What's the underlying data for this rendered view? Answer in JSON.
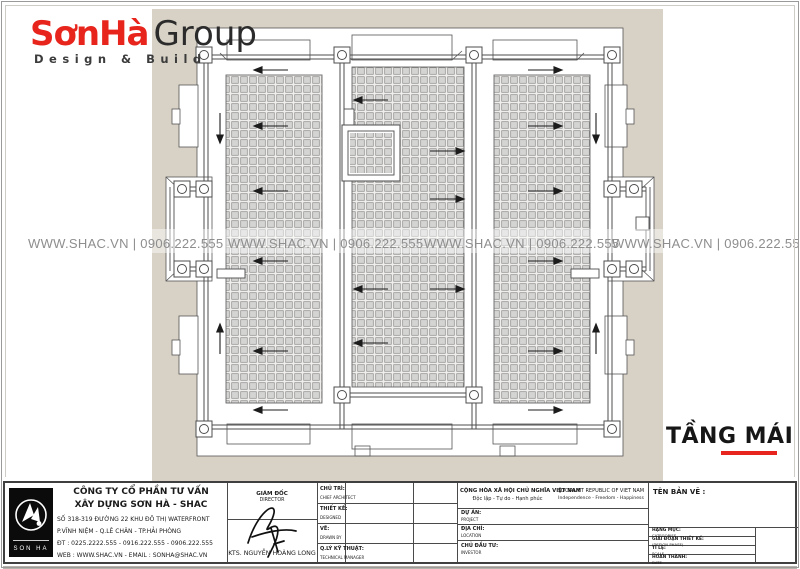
{
  "brand": {
    "name_red": "SơnHà",
    "name_dark": "Group",
    "tagline": "Design & Build"
  },
  "watermark": {
    "text": "WWW.SHAC.VN  |  0906.222.555"
  },
  "drawing": {
    "title": "TẦNG MÁI"
  },
  "title_block": {
    "company": {
      "name_line1": "CÔNG TY CỔ PHẦN TƯ VẤN",
      "name_line2": "XÂY DỰNG SƠN HÀ - SHAC",
      "address_line1": "SỐ 318-319 ĐƯỜNG 22 KHU ĐÔ THỊ WATERFRONT",
      "address_line2": "P.VĨNH NIỆM - Q.LÊ CHÂN - TP.HẢI PHÒNG",
      "phone": "ĐT : 0225.2222.555 - 0916.222.555 - 0906.222.555",
      "web": "WEB : WWW.SHAC.VN - EMAIL : SONHA@SHAC.VN",
      "logo_caption": "SON HA"
    },
    "director": {
      "title_vn": "GIÁM ĐỐC",
      "title_en": "DIRECTOR",
      "name": "KTS. NGUYỄN HOÀNG LONG"
    },
    "roles": [
      {
        "vn": "CHỦ TRÌ:",
        "en": "CHIEF ARCHITECT"
      },
      {
        "vn": "THIẾT KẾ:",
        "en": "DESIGNED"
      },
      {
        "vn": "VẼ:",
        "en": "DRAWN BY"
      },
      {
        "vn": "Q.LÝ KỸ THUẬT:",
        "en": "TECHNICAL MANAGER"
      }
    ],
    "republic": {
      "vn_line1": "CỘNG HÒA XÃ HỘI CHỦ NGHĨA VIỆT NAM",
      "vn_line2": "Độc lập - Tự do - Hạnh phúc",
      "en_line1": "SOCIALIST REPUBLIC OF VIET NAM",
      "en_line2": "Independence - Freedom - Happiness"
    },
    "project_rows": [
      {
        "vn": "DỰ ÁN:",
        "en": "PROJECT"
      },
      {
        "vn": "ĐỊA CHỈ:",
        "en": "LOCATION"
      },
      {
        "vn": "CHỦ ĐẦU TƯ:",
        "en": "INVESTOR"
      }
    ],
    "drawing_name_label": "TÊN BẢN VẼ :",
    "meta_rows": [
      {
        "vn": "HẠNG MỤC:",
        "en": "CATEGORIES"
      },
      {
        "vn": "GIAI ĐOẠN THIẾT KẾ:",
        "en": "(DESIGN PHASE)"
      },
      {
        "vn": "TỈ LỆ:",
        "en": "SCALE"
      },
      {
        "vn": "HOÀN THÀNH:",
        "en": "DATE"
      }
    ]
  },
  "colors": {
    "accent_red": "#e8241f",
    "beige_background": "#d8d2c6",
    "drawing_line": "#4d4d4d",
    "watermark_gray": "#8e8e8e",
    "tile_fill": "#d4d4d3"
  }
}
